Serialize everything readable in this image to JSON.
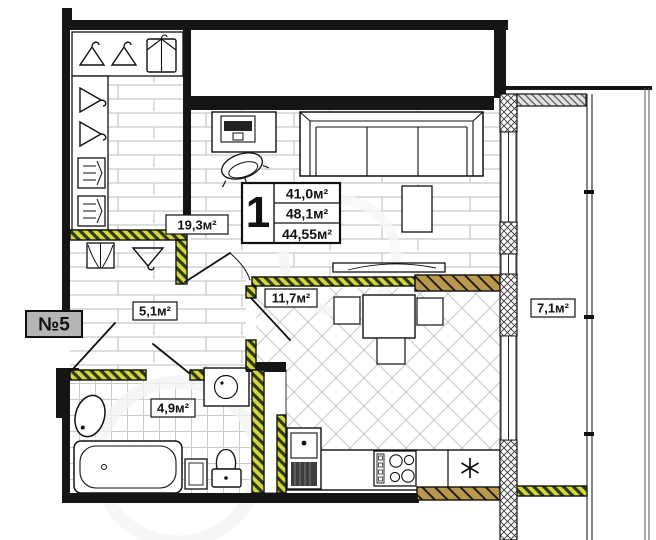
{
  "plan": {
    "unit_badge": "№5",
    "summary": {
      "rooms_count": "1",
      "areas": [
        "41,0м²",
        "48,1м²",
        "44,55м²"
      ]
    },
    "room_labels": {
      "living_room": "19,3м²",
      "hallway": "5,1м²",
      "kitchen": "11,7м²",
      "balcony": "7,1м²",
      "bathroom": "4,9м²"
    },
    "colors": {
      "wall": "#151515",
      "reduced_total_text": "#ee1111",
      "partition_hatch_light": "#d6d63e",
      "partition_hatch_dark": "#2e3a10",
      "masonry_hatch": "#b9984d",
      "badge_bg": "#b5b5b5",
      "floor_line": "#c9c9c9"
    },
    "icons": {
      "fridge": "six-ray-asterisk",
      "hangers": "clothes-hanger",
      "wardrobe": "open-wardrobe-doors",
      "garment_bag": "garment-cover"
    }
  }
}
